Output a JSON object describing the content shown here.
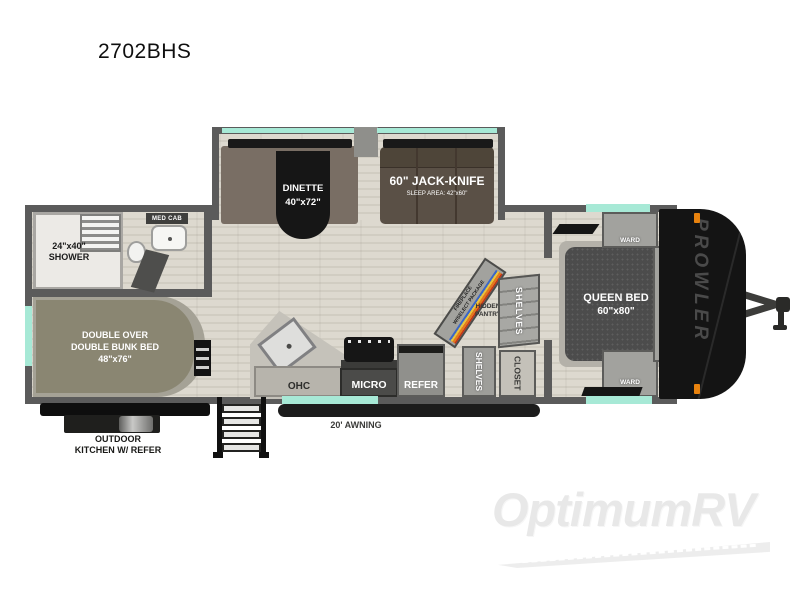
{
  "title": "2702BHS",
  "watermark": {
    "brand": "OptimumRV"
  },
  "colors": {
    "accent_teal": "#a7e9d6",
    "wall_gray": "#5b5b5b",
    "marker_orange": "#e8820e"
  },
  "slideout": {
    "dinette": {
      "name": "DINETTE",
      "size": "40\"x72\""
    },
    "jackknife": {
      "name": "60\" JACK-KNIFE",
      "sleep_area": "SLEEP AREA: 42\"x60\""
    }
  },
  "bathroom": {
    "shower_size": "24\"x40\"",
    "shower_label": "SHOWER",
    "med_cab": "MED CAB"
  },
  "bunkroom": {
    "line1": "DOUBLE OVER",
    "line2": "DOUBLE BUNK BED",
    "size": "48\"x76\""
  },
  "kitchen": {
    "ohc": "OHC",
    "micro": "MICRO",
    "refer": "REFER"
  },
  "pantry": {
    "fireplace_line1": "FIREPLACE",
    "fireplace_line2": "W/SELECT PACKAGE",
    "hidden_pantry_line1": "HIDDEN",
    "hidden_pantry_line2": "PANTRY",
    "shelves_upper": "SHELVES",
    "shelves_lower": "SHELVES",
    "closet": "CLOSET"
  },
  "bedroom": {
    "bed_name": "QUEEN BED",
    "bed_size": "60\"x80\"",
    "ward_top": "WARD",
    "ward_bottom": "WARD",
    "ohc": "OHC"
  },
  "exterior": {
    "brand": "PROWLER",
    "awning": "20' AWNING",
    "outdoor_kitchen_line1": "OUTDOOR",
    "outdoor_kitchen_line2": "KITCHEN W/ REFER"
  }
}
